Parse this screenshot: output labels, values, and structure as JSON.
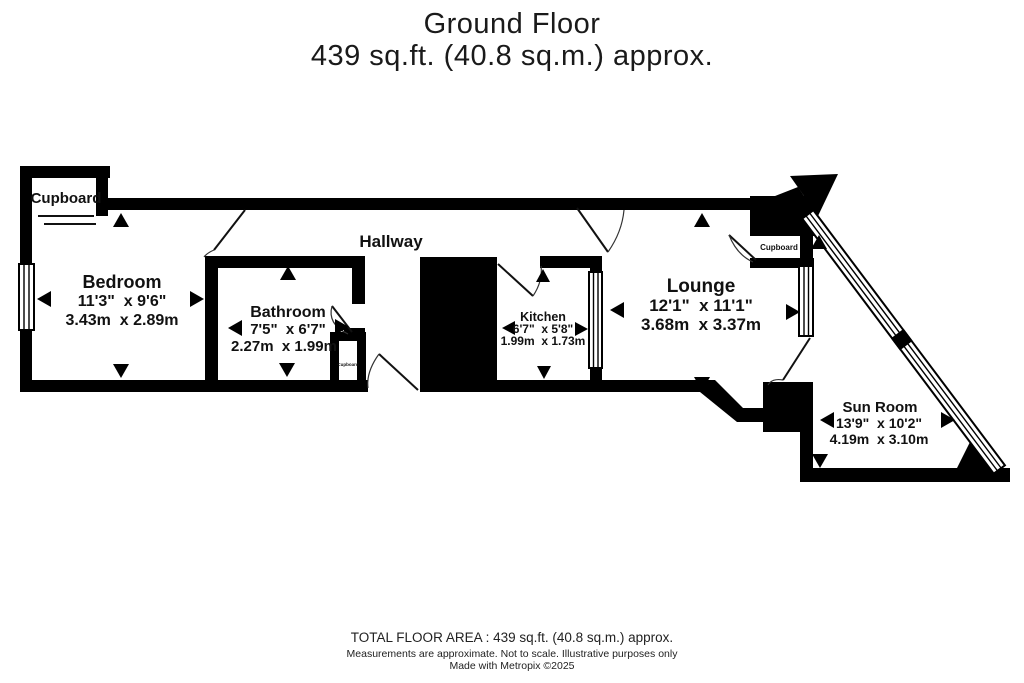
{
  "title": {
    "line1": "Ground Floor",
    "line2": "439 sq.ft. (40.8 sq.m.) approx."
  },
  "rooms": {
    "hallway": {
      "name": "Hallway"
    },
    "bedroom": {
      "name": "Bedroom",
      "imperial": "11'3\"  x 9'6\"",
      "metric": "3.43m  x 2.89m"
    },
    "bathroom": {
      "name": "Bathroom",
      "imperial": "7'5\"  x 6'7\"",
      "metric": "2.27m  x 1.99m"
    },
    "kitchen": {
      "name": "Kitchen",
      "imperial": "6'7\"  x 5'8\"",
      "metric": "1.99m  x 1.73m"
    },
    "lounge": {
      "name": "Lounge",
      "imperial": "12'1\"  x 11'1\"",
      "metric": "3.68m  x 3.37m"
    },
    "sunroom": {
      "name": "Sun Room",
      "imperial": "13'9\"  x 10'2\"",
      "metric": "4.19m  x 3.10m"
    },
    "cupboard_topleft": {
      "name": "Cupboard"
    },
    "cupboard_hall": {
      "name": "Cupboard"
    },
    "cupboard_lounge": {
      "name": "Cupboard"
    }
  },
  "footer": {
    "line1": "TOTAL FLOOR AREA : 439 sq.ft. (40.8 sq.m.) approx.",
    "line2": "Measurements are approximate.  Not to scale.  Illustrative purposes only",
    "line3": "Made with Metropix ©2025"
  },
  "colors": {
    "wall": "#000000",
    "background": "#ffffff",
    "text": "#111111"
  }
}
